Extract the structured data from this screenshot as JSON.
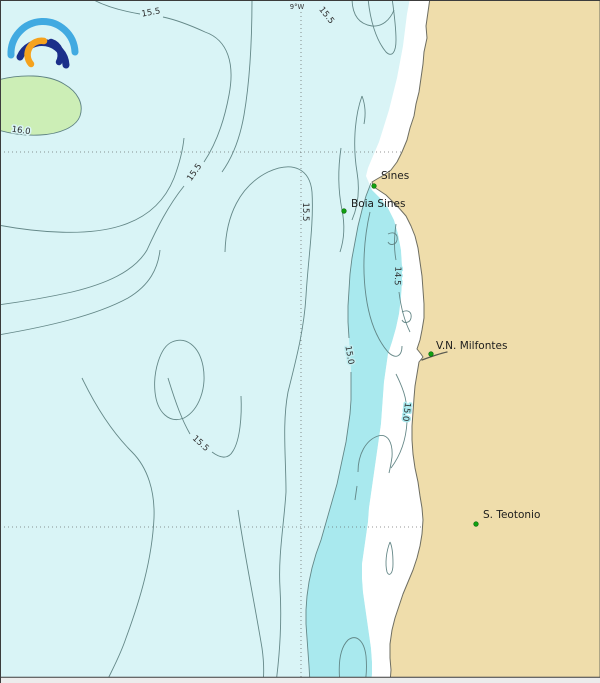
{
  "graticule": {
    "lon_label": "9°W"
  },
  "contour_labels": [
    {
      "text": "15.5"
    },
    {
      "text": "15.5"
    },
    {
      "text": "16.0"
    },
    {
      "text": "15.5"
    },
    {
      "text": "15.5"
    },
    {
      "text": "14.5"
    },
    {
      "text": "15.0"
    },
    {
      "text": "15.0"
    },
    {
      "text": "15.5"
    }
  ],
  "places": [
    {
      "name": "Sines"
    },
    {
      "name": "Boia Sines"
    },
    {
      "name": "V.N. Milfontes"
    },
    {
      "name": "S. Teotonio"
    }
  ],
  "colors": {
    "ocean_15_16": "#d9f4f6",
    "coastal_band_14_15": "#a9e9ee",
    "warm_patch_above_16": "#cceeb6",
    "land": "#efddab",
    "no_data_strip": "#ffffff",
    "contour_line": "#5e8282",
    "place_marker_green": "#11a011",
    "logo_outer_blue": "#41aae1",
    "logo_navy": "#1b2f8a",
    "logo_orange": "#f5a21d"
  }
}
